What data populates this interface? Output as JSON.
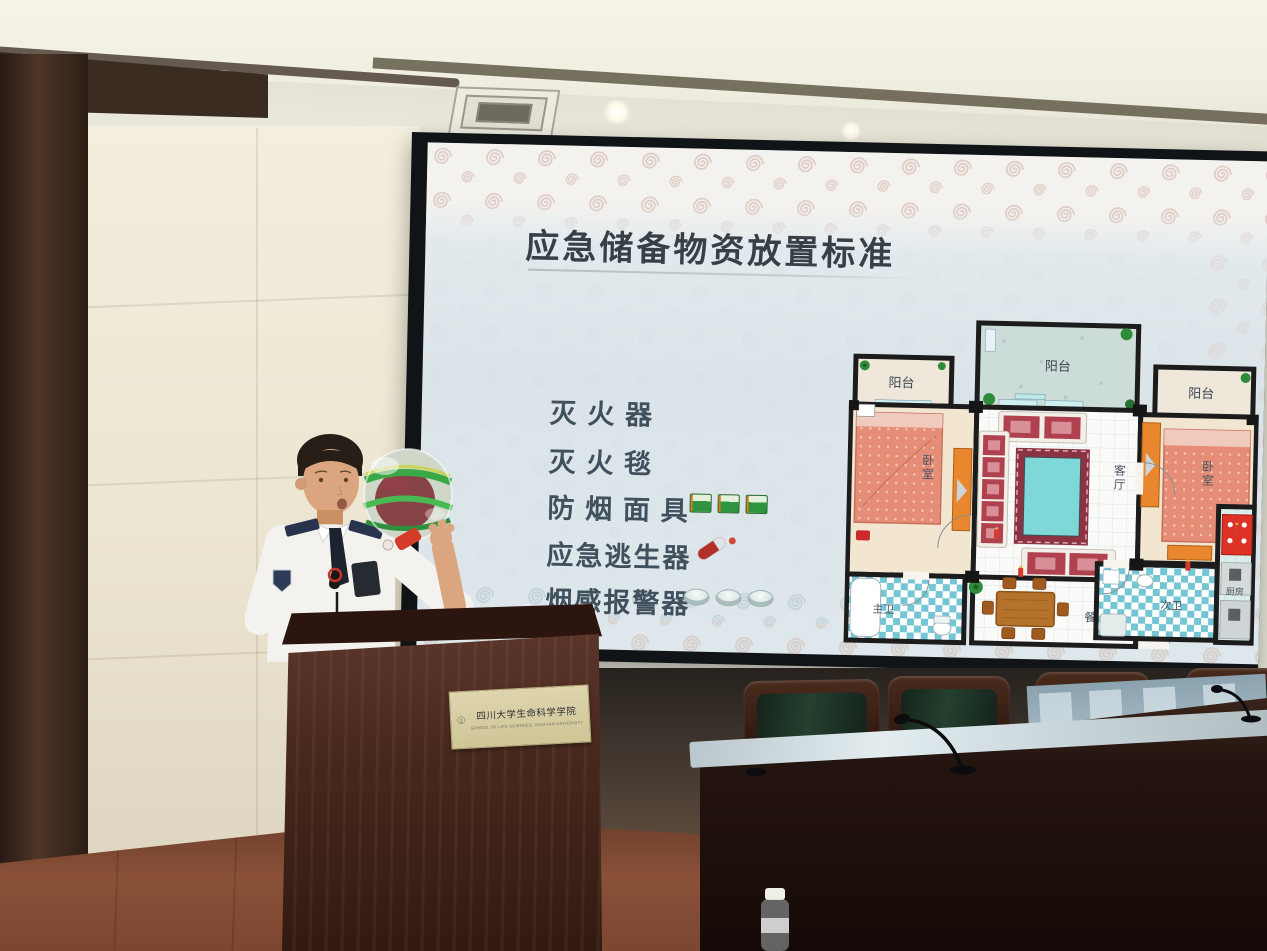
{
  "slide": {
    "title": "应急储备物资放置标准",
    "items": [
      {
        "label": "灭 火 器"
      },
      {
        "label": "灭 火 毯"
      },
      {
        "label": "防 烟 面 具",
        "icon": "smoke-mask-pack",
        "icon_count": 3
      },
      {
        "label": "应急逃生器",
        "icon": "escape-device",
        "icon_count": 1
      },
      {
        "label": "烟感报警器",
        "icon": "smoke-alarm",
        "icon_count": 3
      }
    ],
    "floorplan_labels": {
      "balcony": "阳台",
      "bedroom": "卧室",
      "living_room": "客厅",
      "dining_room": "餐厅",
      "master_bathroom": "主卫",
      "second_bathroom": "次卫",
      "kitchen": "厨房"
    }
  },
  "podium": {
    "plaque_text_cn": "四川大学生命科学学院",
    "plaque_text_en": "SCHOOL OF LIFE SCIENCES, SICHUAN UNIVERSITY"
  },
  "colors": {
    "slide_background": "#dee7eb",
    "slide_title_text": "#383f46",
    "slide_item_text": "#41505d",
    "swirl_pink": "#dfccc5",
    "swirl_blue": "#c3d4da",
    "screen_bezel": "#101417",
    "wall_panel": "#ece6d4",
    "dark_wood": "#3a2a20",
    "podium_wood": "#47281c",
    "plaque_gold": "#d9d0a9",
    "table_wood": "#241410",
    "chair_green": "#24402f",
    "floor_wood": "#8a5138",
    "uniform_white": "#f3f2ee",
    "epaulette_navy": "#28334e",
    "mask_pack_green": "#2f9440",
    "escape_device_red": "#b23028",
    "bed_salmon": "#e58d76",
    "sofa_red": "#b04250",
    "rug_cyan": "#7fd8d8",
    "bath_tile_blue": "#74c6d4",
    "wardrobe_orange": "#e8872e"
  }
}
